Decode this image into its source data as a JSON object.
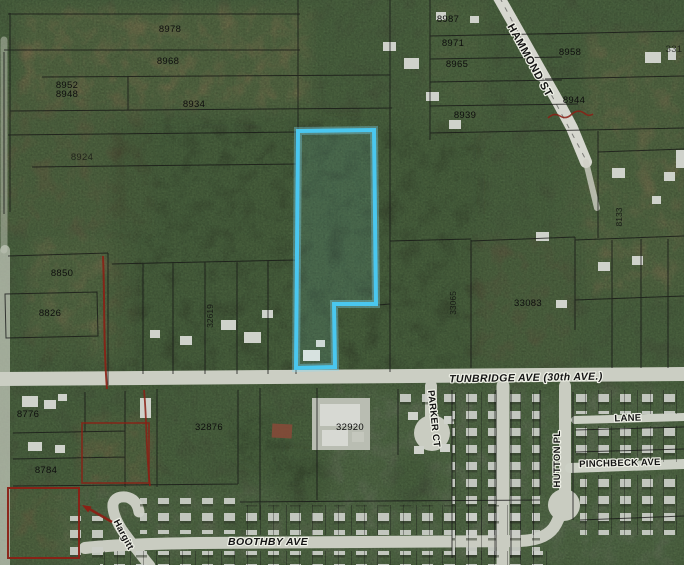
{
  "map": {
    "type": "aerial-parcel-map",
    "highlight_color": "#4AC7EF",
    "annotation_color": "#8B2015",
    "street_labels": {
      "hammond": "HAMMOND ST",
      "tunbridge": "TUNBRIDGE AVE  (30th AVE.)",
      "parker_ct": "PARKER CT",
      "lane": "LANE",
      "pinchbeck": "PINCHBECK AVE",
      "hutton_pl": "HUTTON PL",
      "boothby": "BOOTHBY AVE",
      "hargitt": "Hargitt"
    },
    "parcel_labels": {
      "p8978": "8978",
      "p8968": "8968",
      "p8952": "8952",
      "p8948": "8948",
      "p8934": "8934",
      "p8924": "8924",
      "p8850": "8850",
      "p8826": "8826",
      "p8987": "8987",
      "p8971": "8971",
      "p8965": "8965",
      "p8958": "8958",
      "p8944": "8944",
      "p8939": "8939",
      "p331": "331",
      "p33065": "33065",
      "p33083": "33083",
      "p32619": "32619",
      "p8133": "8133",
      "p32876": "32876",
      "p32920": "32920",
      "p8776": "8776",
      "p8784": "8784"
    }
  }
}
